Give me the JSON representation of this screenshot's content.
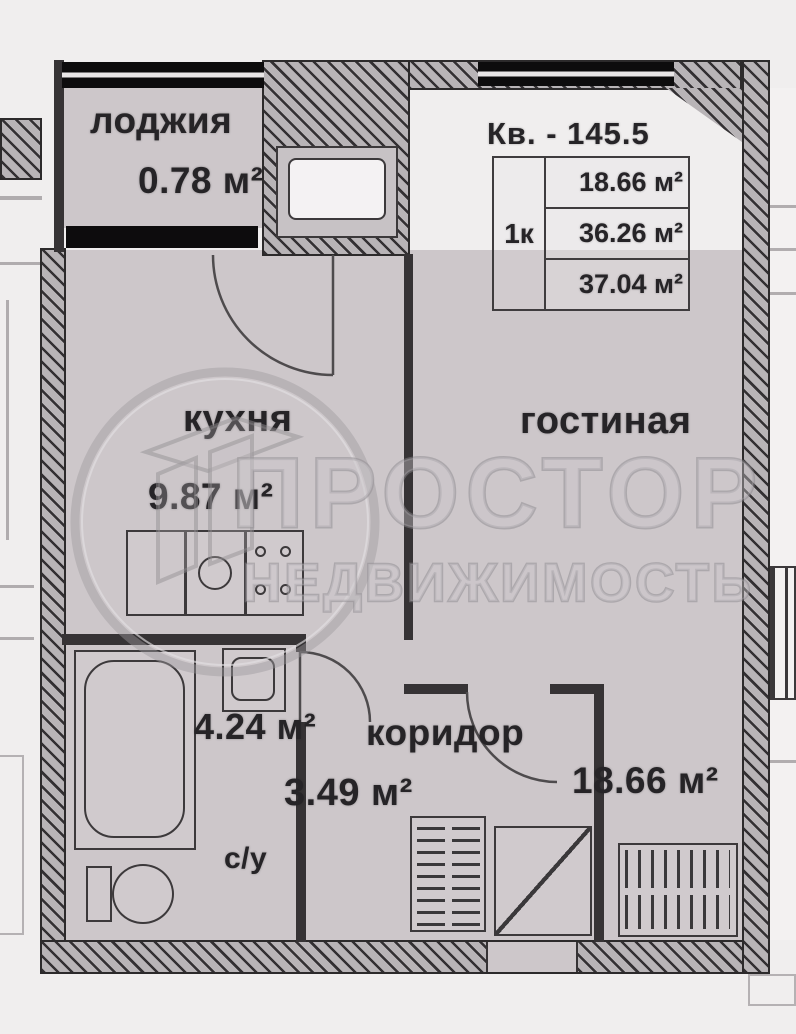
{
  "header": {
    "apartment": "Кв. - 145.5"
  },
  "info_table": {
    "rooms": "1к",
    "values": [
      "18.66 м²",
      "36.26 м²",
      "37.04 м²"
    ]
  },
  "rooms": {
    "loggia": {
      "name": "лоджия",
      "area": "0.78 м²"
    },
    "kitchen": {
      "name": "кухня",
      "area": "9.87 м²"
    },
    "living": {
      "name": "гостиная",
      "area": "18.66 м²"
    },
    "corridor": {
      "name": "коридор",
      "area": "3.49 м²"
    },
    "bathroom": {
      "name": "с/у",
      "area": "4.24 м²"
    }
  },
  "watermark": {
    "line1": "ПРОСТОР",
    "line2": "НЕДВИЖИМОСТЬ",
    "logo": "house-in-circle"
  },
  "colors": {
    "floor": "#cdc7ca",
    "wall": "#363335",
    "window": "#0d0c0d",
    "background": "#f0eeee",
    "watermark": "#aba7ab",
    "text": "#262427"
  }
}
